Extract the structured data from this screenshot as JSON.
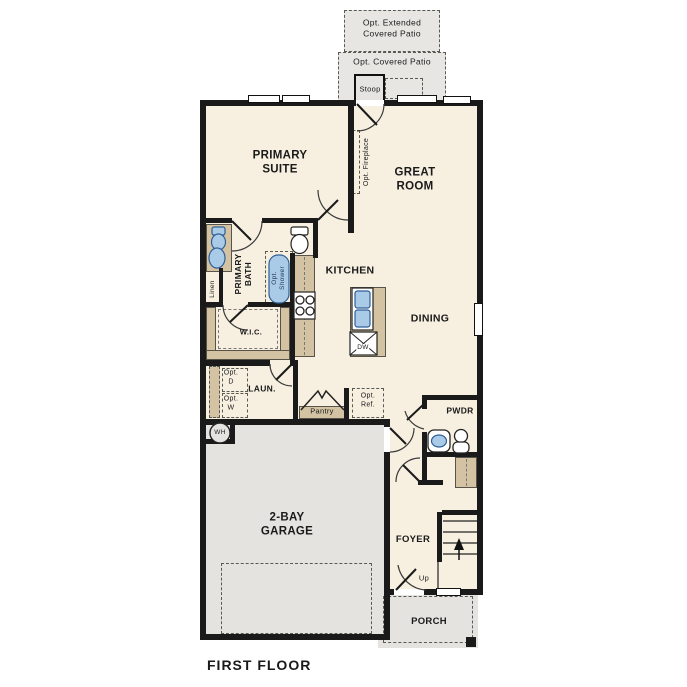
{
  "title": "FIRST FLOOR",
  "outdoor": {
    "extended_patio": "Opt. Extended\nCovered Patio",
    "covered_patio": "Opt. Covered Patio",
    "stoop": "Stoop",
    "porch": "PORCH"
  },
  "rooms": {
    "primary_suite": "PRIMARY\nSUITE",
    "great_room": "GREAT\nROOM",
    "kitchen": "KITCHEN",
    "dining": "DINING",
    "primary_bath": "PRIMARY\nBATH",
    "wic": "W.I.C.",
    "laundry": "LAUN.",
    "pantry": "Pantry",
    "powder": "PWDR",
    "foyer": "FOYER",
    "garage": "2-BAY\nGARAGE"
  },
  "features": {
    "opt_fireplace": "Opt. Fireplace",
    "opt_shower": "Opt.\nShower",
    "linen": "Linen",
    "opt_dryer": "Opt.\nD",
    "opt_washer": "Opt.\nW",
    "opt_fridge": "Opt.\nRef.",
    "dishwasher": "DW",
    "water_heater": "WH",
    "stairs_up": "Up"
  },
  "colors": {
    "floor": "#f7f0e1",
    "hardscape": "#e4e3df",
    "casework": "#d3c3a3",
    "fixture": "#aacbe7",
    "wall": "#1a1a1a"
  }
}
